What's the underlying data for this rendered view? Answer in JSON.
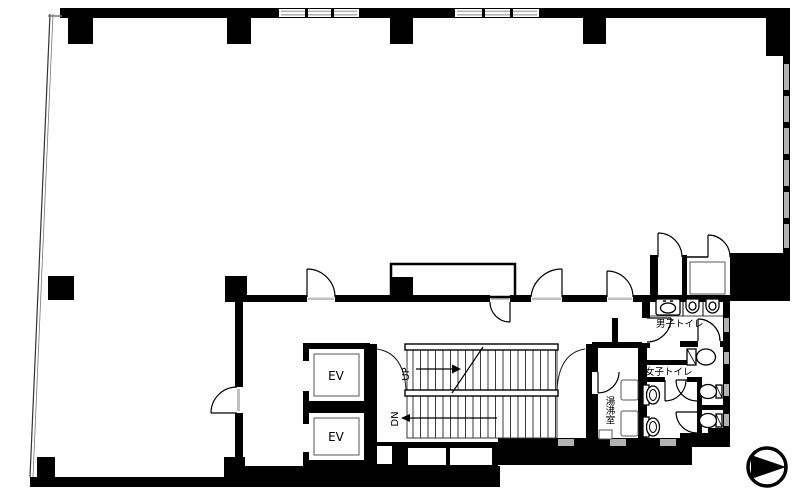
{
  "plan": {
    "type": "building-floor-plan",
    "labels": {
      "elevator_1": "EV",
      "elevator_2": "EV",
      "stairs_up": "UP",
      "stairs_down": "DN",
      "mens_toilet": "男子トイレ",
      "womens_toilet": "女子トイレ",
      "kitchenette": "湯沸室"
    },
    "colors": {
      "wall": "#000000",
      "background": "#ffffff",
      "window": "#b2b2b2",
      "thin_line": "#1a1a1a"
    },
    "icons": {
      "compass": "direction-arrow-in-circle",
      "toilet": "toilet-bowl",
      "urinal": "urinal",
      "sink": "wash-basin",
      "door": "quarter-circle-door-swing",
      "stairs": "parallel-tread-lines"
    }
  }
}
